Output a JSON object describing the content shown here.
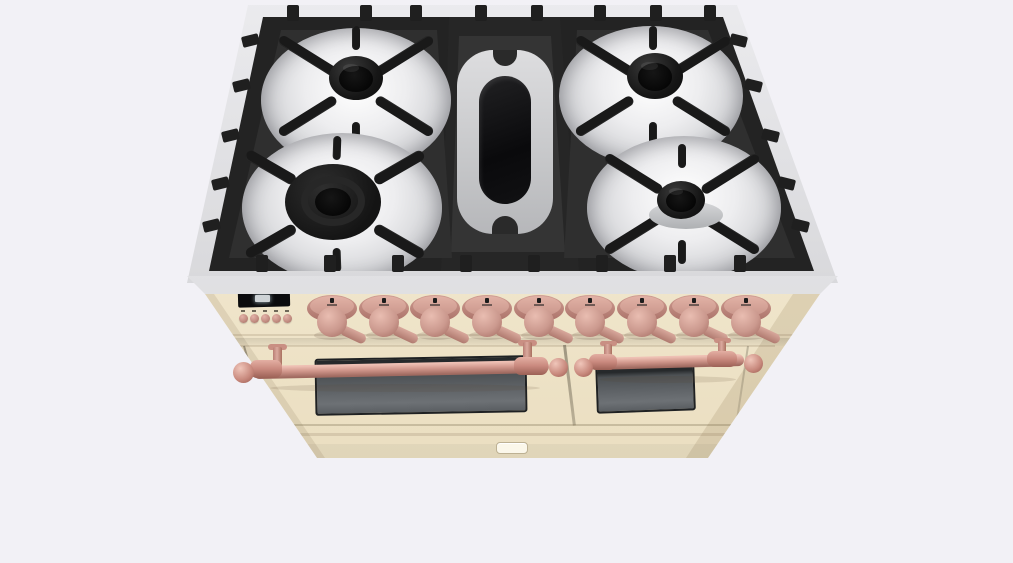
{
  "scene": {
    "description": "3D render of a freestanding range cooker viewed from the top front",
    "style": "antique cream body with copper control knobs and copper towel-rail oven handles",
    "background_color": "#f2f1f6"
  },
  "colors": {
    "background": "#f2f1f6",
    "body_cream": "#f1e7cd",
    "body_cream_shade": "#e4d8b8",
    "steel_rim": "#d7d7da",
    "grate_iron": "#232323",
    "burner_well_steel": "#ededef",
    "copper_trim": "#cb968c",
    "copper_highlight": "#eec0b4",
    "copper_shadow": "#a06a60",
    "oven_glass": "#5d6165",
    "display_bezel": "#0b0b0d",
    "display_glow": "#dfe5e8",
    "badge_plate": "#fbf7ea"
  },
  "cooktop": {
    "material": "stainless steel with cast-iron grates",
    "sections": 3,
    "burners": [
      {
        "id": "back-left",
        "type": "standard-burner"
      },
      {
        "id": "front-left",
        "type": "double-ring-wok-burner"
      },
      {
        "id": "center",
        "type": "oval-griddle-burner"
      },
      {
        "id": "back-right",
        "type": "standard-burner"
      },
      {
        "id": "front-right",
        "type": "standard-burner"
      }
    ],
    "top_tab_count": 8,
    "left_tab_count": 5,
    "right_tab_count": 5,
    "bottom_tab_count": 8
  },
  "control_panel": {
    "display": {
      "type": "digital-clock",
      "lit": true,
      "text": ""
    },
    "button_count": 5,
    "knob_count": 9,
    "knob_pointer_direction": "lower-right"
  },
  "ovens": {
    "door_count": 2,
    "left_door": {
      "handle": "copper towel rail with ball finials",
      "window": true
    },
    "right_door": {
      "handle": "copper towel rail with ball finials",
      "window": true
    },
    "badge_text": ""
  }
}
